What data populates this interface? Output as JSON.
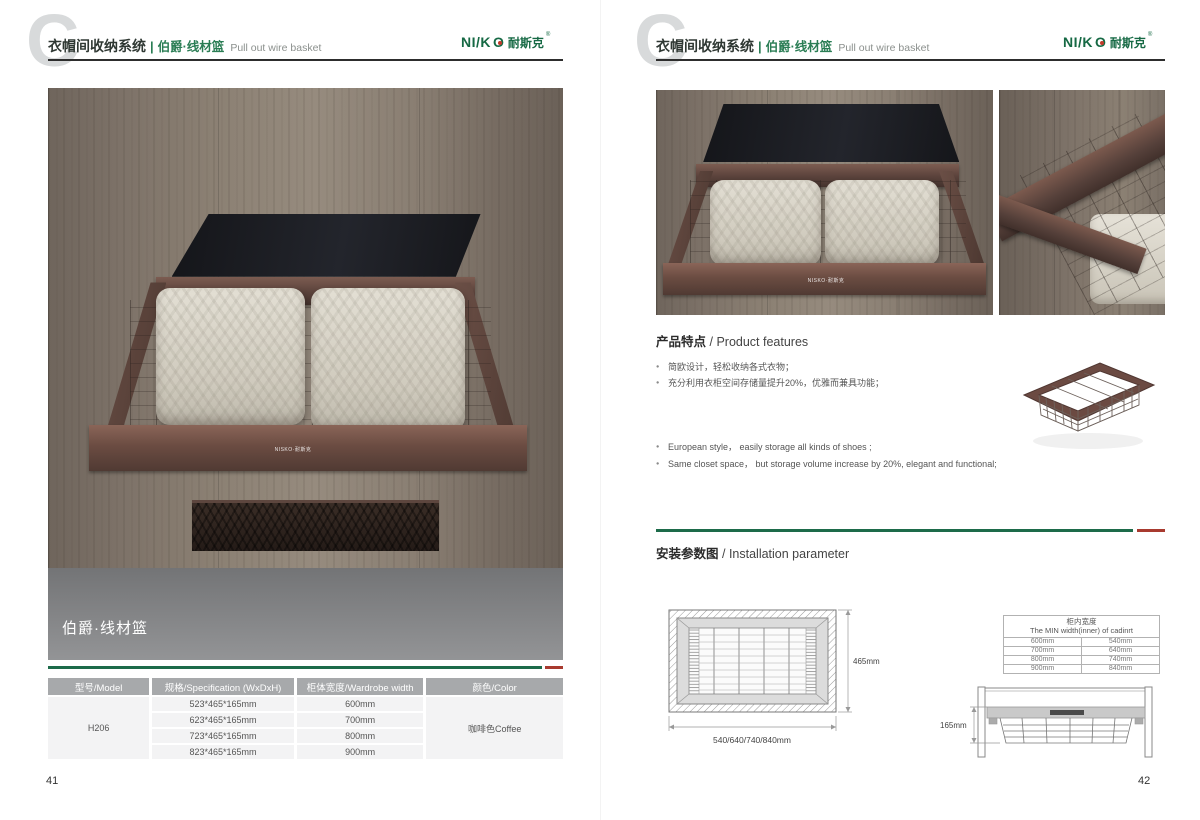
{
  "header": {
    "c_mark": "C",
    "system_title": "衣帽间收纳系统",
    "divider": "|",
    "product_cn": "伯爵·线材篮",
    "product_en": "Pull out wire basket"
  },
  "brand": {
    "logo_part1": "NI/K",
    "logo_o": "O",
    "logo_cn": "耐斯克",
    "registered": "®"
  },
  "left_page": {
    "page_number": "41",
    "photo_caption": "伯爵·线材篮",
    "rail_brand_text": "NISKO·耐斯克",
    "spec_table": {
      "headers": [
        "型号/Model",
        "规格/Specification (WxDxH)",
        "柜体宽度/Wardrobe width",
        "颜色/Color"
      ],
      "model": "H206",
      "color": "咖啡色Coffee",
      "rows": [
        {
          "spec": "523*465*165mm",
          "width": "600mm"
        },
        {
          "spec": "623*465*165mm",
          "width": "700mm"
        },
        {
          "spec": "723*465*165mm",
          "width": "800mm"
        },
        {
          "spec": "823*465*165mm",
          "width": "900mm"
        }
      ]
    }
  },
  "right_page": {
    "page_number": "42",
    "features": {
      "title_cn": "产品特点",
      "title_sep": " / ",
      "title_en": "Product features",
      "bullets_cn": [
        "简欧设计，轻松收纳各式衣物；",
        "充分利用衣柜空间存储量提升20%，优雅而兼具功能；"
      ],
      "bullets_en": [
        "European style， easily storage all kinds of shoes ;",
        "Same closet space， but storage volume increase by 20%, elegant and functional;"
      ]
    },
    "installation": {
      "title_cn": "安装参数图",
      "title_sep": " / ",
      "title_en": "Installation parameter",
      "top_view": {
        "depth_label": "465mm",
        "width_label": "540/640/740/840mm"
      },
      "width_table": {
        "title_cn": "柜内宽度",
        "title_en": "The MIN width(inner) of cadinrt",
        "rows": [
          [
            "600mm",
            "540mm"
          ],
          [
            "700mm",
            "640mm"
          ],
          [
            "800mm",
            "740mm"
          ],
          [
            "900mm",
            "840mm"
          ]
        ]
      },
      "front_view": {
        "height_label": "165mm"
      }
    }
  },
  "colors": {
    "accent_green": "#1d6b4a",
    "accent_red": "#a83a2f",
    "logo_green": "#166944",
    "product_title_green": "#2a7d54",
    "table_header_bg": "#a7a9ab",
    "table_row_bg": "#f3f3f4",
    "frame_coffee": "#5d463e"
  }
}
